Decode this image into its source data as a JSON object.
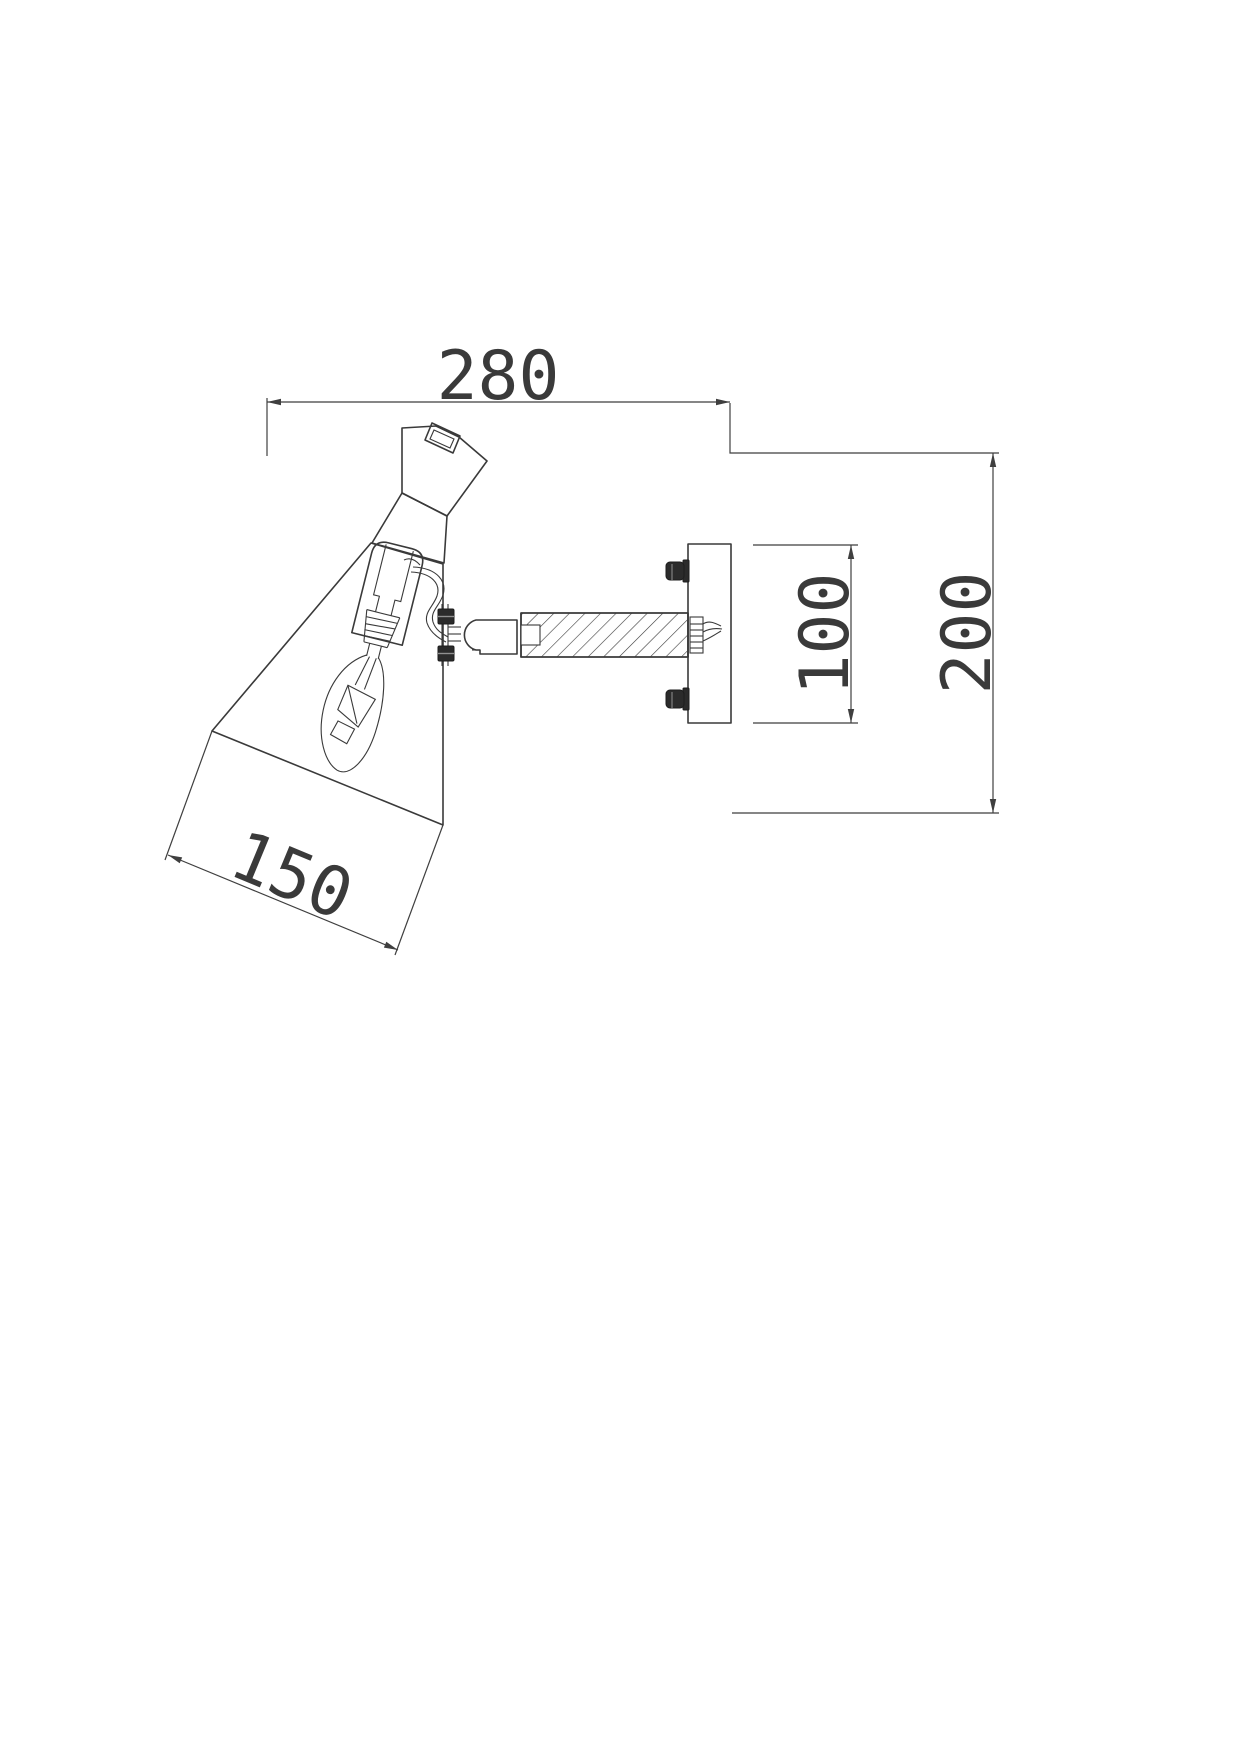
{
  "document": {
    "kind": "technical dimension drawing",
    "subject": "wall-mounted spot lamp, side section view",
    "background_color": "#ffffff",
    "line_color": "#3a3a3a"
  },
  "dimensions": {
    "overall_width": "280",
    "overall_height": "200",
    "plate_height": "100",
    "shade_length": "150"
  },
  "parts": [
    "lamp-shade",
    "shade-neck",
    "adjustment-knob",
    "lamp-socket",
    "candle-bulb",
    "filament",
    "wire",
    "swivel-joint",
    "threaded-arm",
    "wall-plate",
    "mounting-screws",
    "fixing-nut"
  ]
}
